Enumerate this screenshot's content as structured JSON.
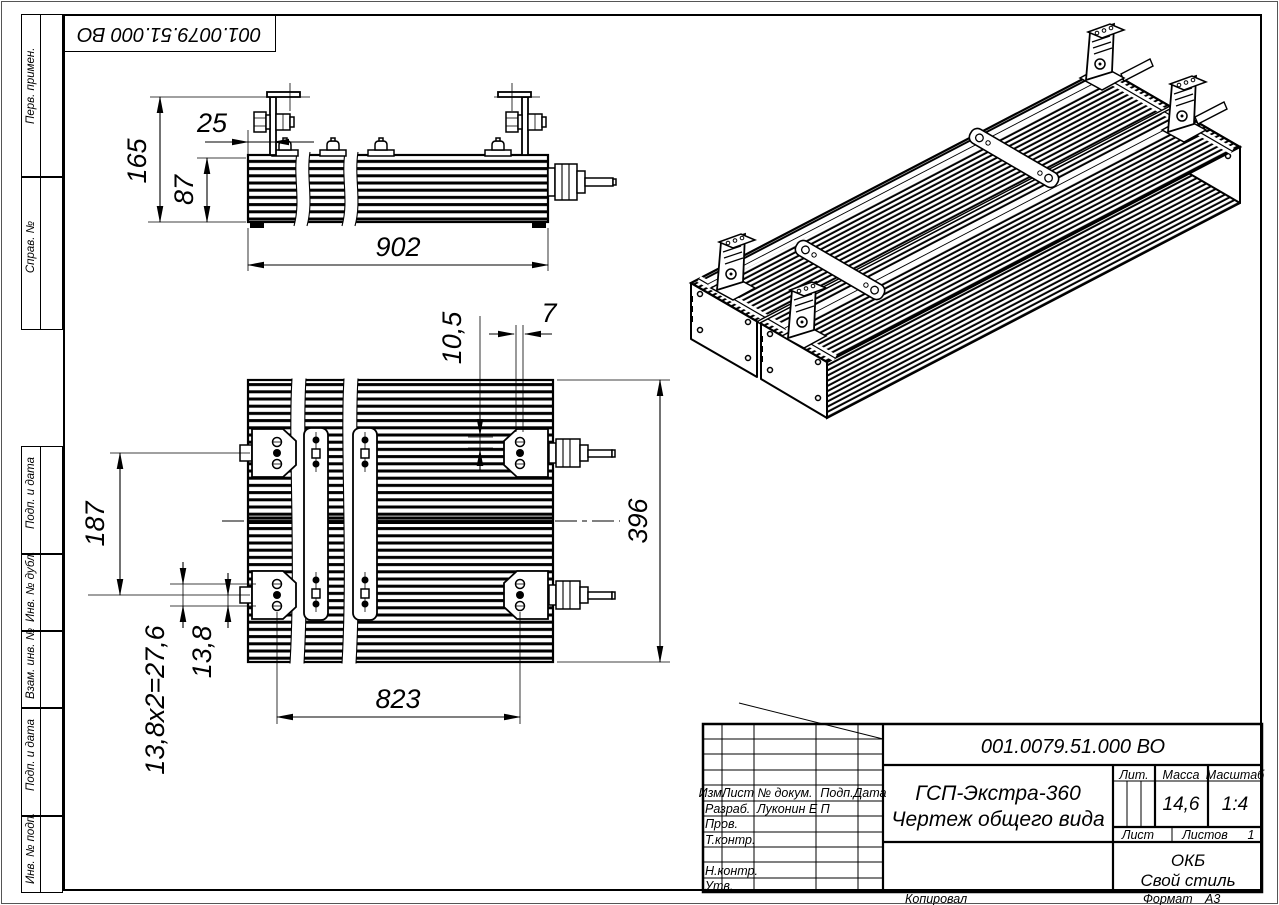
{
  "doc": {
    "designation": "001.0079.51.000 ВО",
    "title_line1": "ГСП-Экстра-360",
    "title_line2": "Чертеж общего вида",
    "company_line1": "ОКБ",
    "company_line2": "Свой стиль"
  },
  "title_block": {
    "header": [
      "Изм.",
      "Лист",
      "№ докум.",
      "Подп.",
      "Дата"
    ],
    "rows": [
      {
        "label": "Разраб.",
        "value": "Луконин Е П"
      },
      {
        "label": "Пров.",
        "value": ""
      },
      {
        "label": "Т.контр.",
        "value": ""
      },
      {
        "label": "Н.контр.",
        "value": ""
      },
      {
        "label": "Утв.",
        "value": ""
      }
    ],
    "lit_label": "Лит.",
    "mass_label": "Масса",
    "scale_label": "Масштаб",
    "mass_value": "14,6",
    "scale_value": "1:4",
    "sheet_label": "Лист",
    "sheets_label": "Листов",
    "sheets_value": "1"
  },
  "footer": {
    "copied": "Копировал",
    "format_label": "Формат",
    "format_value": "А3"
  },
  "margin": {
    "top_labels": [
      "Перв. примен.",
      "Справ. №"
    ],
    "bottom_labels": [
      "Подп. и дата",
      "Инв. № дубл.",
      "Взам. инв. №",
      "Подп. и дата",
      "Инв. № подп."
    ]
  },
  "dims": {
    "side": {
      "total_height": "165",
      "body_height": "87",
      "bracket_offset": "25",
      "length": "902"
    },
    "plan": {
      "slot_width": "7",
      "slot_offset": "10,5",
      "bracket_span": "187",
      "width": "396",
      "hole_pitch": "13,8",
      "hole_pitch_total": "13,8х2=27,6",
      "mount_span": "823"
    }
  }
}
